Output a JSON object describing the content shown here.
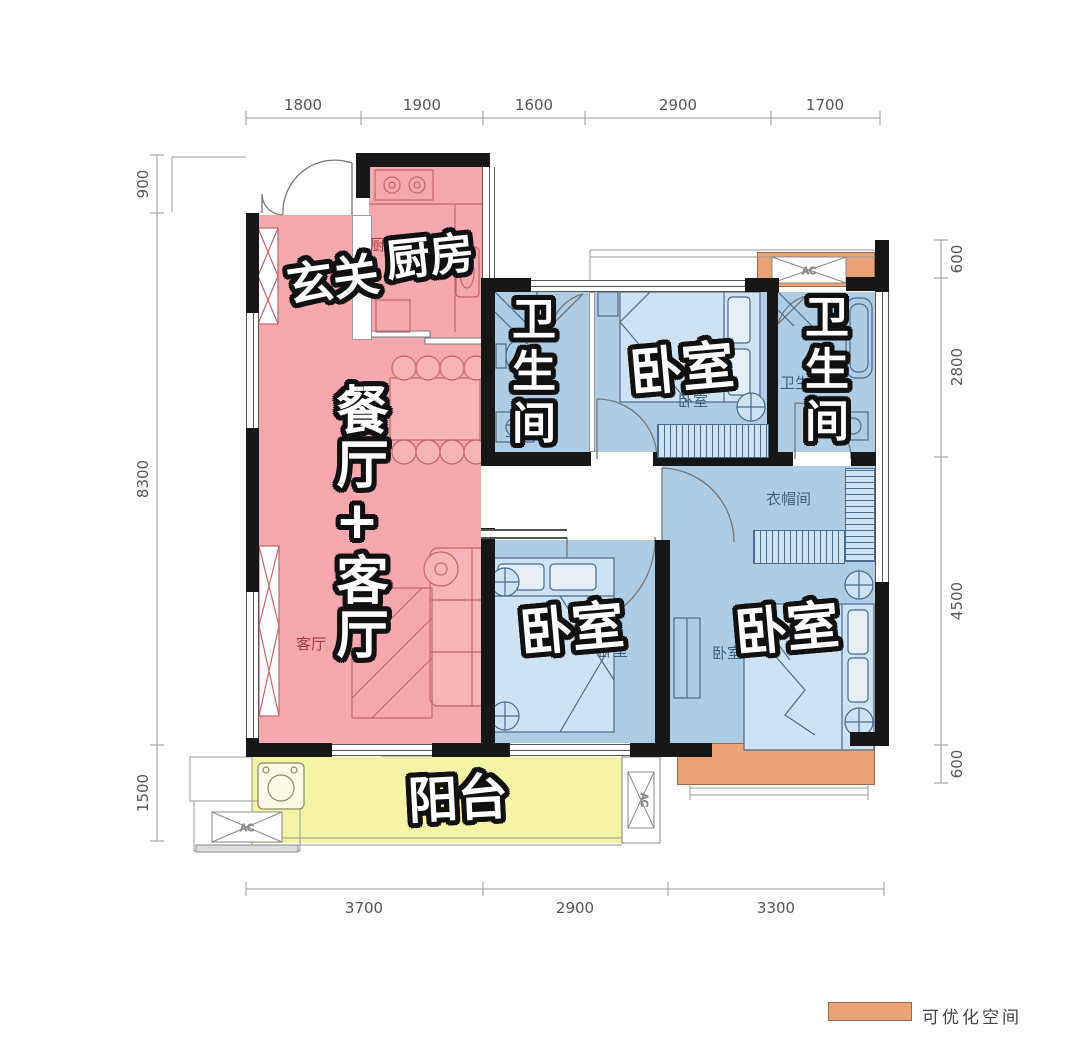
{
  "rooms": {
    "entry": {
      "label": "玄关"
    },
    "kitchen": {
      "label": "厨房",
      "small": "厨房"
    },
    "dining_living": {
      "label": "餐厅+客厅",
      "small_dining": "餐厅",
      "small_living": "客厅"
    },
    "bath_left": {
      "label": "卫生间",
      "small": "卫生间"
    },
    "bed_top": {
      "label": "卧室",
      "small": "卧室"
    },
    "bath_right": {
      "label": "卫生间",
      "small": "卫生间"
    },
    "cloakroom": {
      "small": "衣帽间"
    },
    "bed_mid": {
      "label": "卧室",
      "small": "卧室"
    },
    "bed_right": {
      "label": "卧室",
      "small": "卧室"
    },
    "balcony": {
      "label": "阳台"
    }
  },
  "dimensions": {
    "top": [
      "1800",
      "1900",
      "1600",
      "2900",
      "1700"
    ],
    "left": [
      "900",
      "8300",
      "1500"
    ],
    "right": [
      "600",
      "2800",
      "4500",
      "600"
    ],
    "bottom": [
      "3700",
      "2900",
      "3300"
    ]
  },
  "ac_label": "AC",
  "legend": {
    "label": "可优化空间"
  },
  "colors": {
    "zone_pink": "#F5A8AD",
    "zone_blue": "#AECDE5",
    "zone_yellow": "#F5F3A5",
    "zone_orange": "#E9A377"
  }
}
